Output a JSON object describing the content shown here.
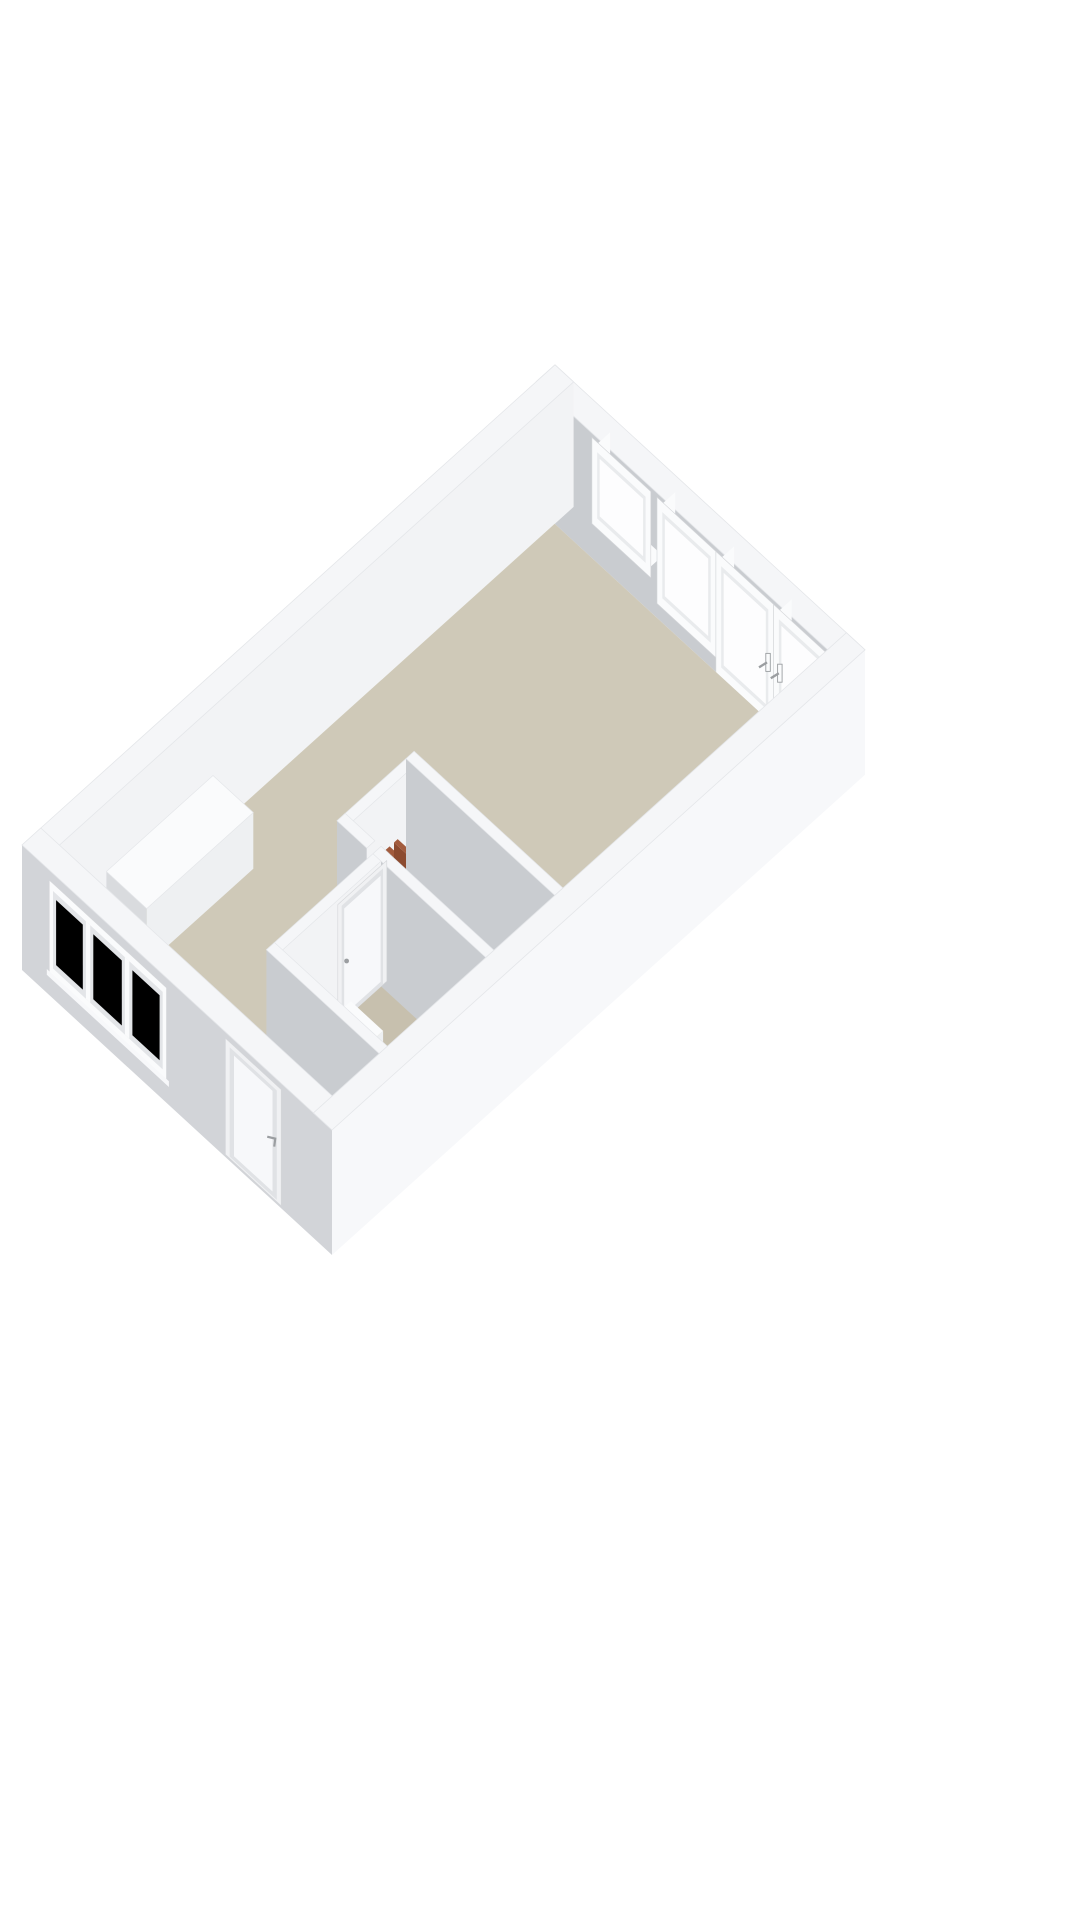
{
  "scene": {
    "kind": "3d-floorplan-render",
    "view": "isometric-dollhouse",
    "background": "#ffffff"
  },
  "colors": {
    "background": "#ffffff",
    "floor": "#cfc9b8",
    "floor_bathroom": "#c7c0ae",
    "floor_hall": "#d7d2c5",
    "wall_top": "#f5f6f8",
    "wall_top_edge": "#e4e6e9",
    "wall_lit": "#f2f3f5",
    "wall_bright": "#f7f8fa",
    "wall_shade": "#c9ccd0",
    "ext_shade": "#d2d4d8",
    "frame_white": "#fafbfc",
    "frame_inner": "#e9ebed",
    "frame_stroke": "#d4d6d9",
    "glass_through": "#fdfdfe",
    "glass_ext": "#e3e5e8",
    "door_leaf": "#a9acaf",
    "door_glass": "#d7d1c1",
    "door_frame": "#f0f1f3",
    "ext_door_leaf": "#e0e2e5",
    "slab_dark_face": "#262019",
    "slab_dark_side": "#362c25",
    "slab_dark_top": "#453a30",
    "slab_rust_face": "#8c4b30",
    "slab_rust_side": "#6f3c26",
    "slab_rust_top": "#a25b3d",
    "fixture_top": "#fafbfc",
    "fixture_side": "#d9dbde",
    "fixture_front": "#eef0f2",
    "handle": "#9b9ea1",
    "seam": "#d9dbde"
  },
  "features": [
    {
      "name": "floor-main",
      "kind": "floor"
    },
    {
      "name": "floor-bathroom",
      "kind": "floor"
    },
    {
      "name": "floor-hallway",
      "kind": "floor"
    },
    {
      "name": "north-east-wall",
      "kind": "exterior-wall"
    },
    {
      "name": "north-west-wall",
      "kind": "exterior-wall"
    },
    {
      "name": "south-west-wall",
      "kind": "exterior-wall"
    },
    {
      "name": "south-east-wall",
      "kind": "exterior-wall"
    },
    {
      "name": "window-ne-fixed",
      "kind": "window"
    },
    {
      "name": "window-ne-tall",
      "kind": "window"
    },
    {
      "name": "french-doors",
      "kind": "glass-doors"
    },
    {
      "name": "french-door-handles",
      "kind": "hardware"
    },
    {
      "name": "triple-window-sw",
      "kind": "window"
    },
    {
      "name": "entry-door",
      "kind": "door"
    },
    {
      "name": "entry-door-handle",
      "kind": "hardware"
    },
    {
      "name": "kitchen-counter",
      "kind": "furniture"
    },
    {
      "name": "meter-cupboard",
      "kind": "closet"
    },
    {
      "name": "meter-cupboard-panels-dark",
      "kind": "equipment"
    },
    {
      "name": "meter-cupboard-panels-rust",
      "kind": "equipment"
    },
    {
      "name": "hallway-door",
      "kind": "interior-door"
    },
    {
      "name": "bathroom-door",
      "kind": "interior-door"
    },
    {
      "name": "bathroom-walls",
      "kind": "interior-wall"
    },
    {
      "name": "bathroom-tray",
      "kind": "fixture"
    },
    {
      "name": "toilet",
      "kind": "fixture"
    }
  ]
}
